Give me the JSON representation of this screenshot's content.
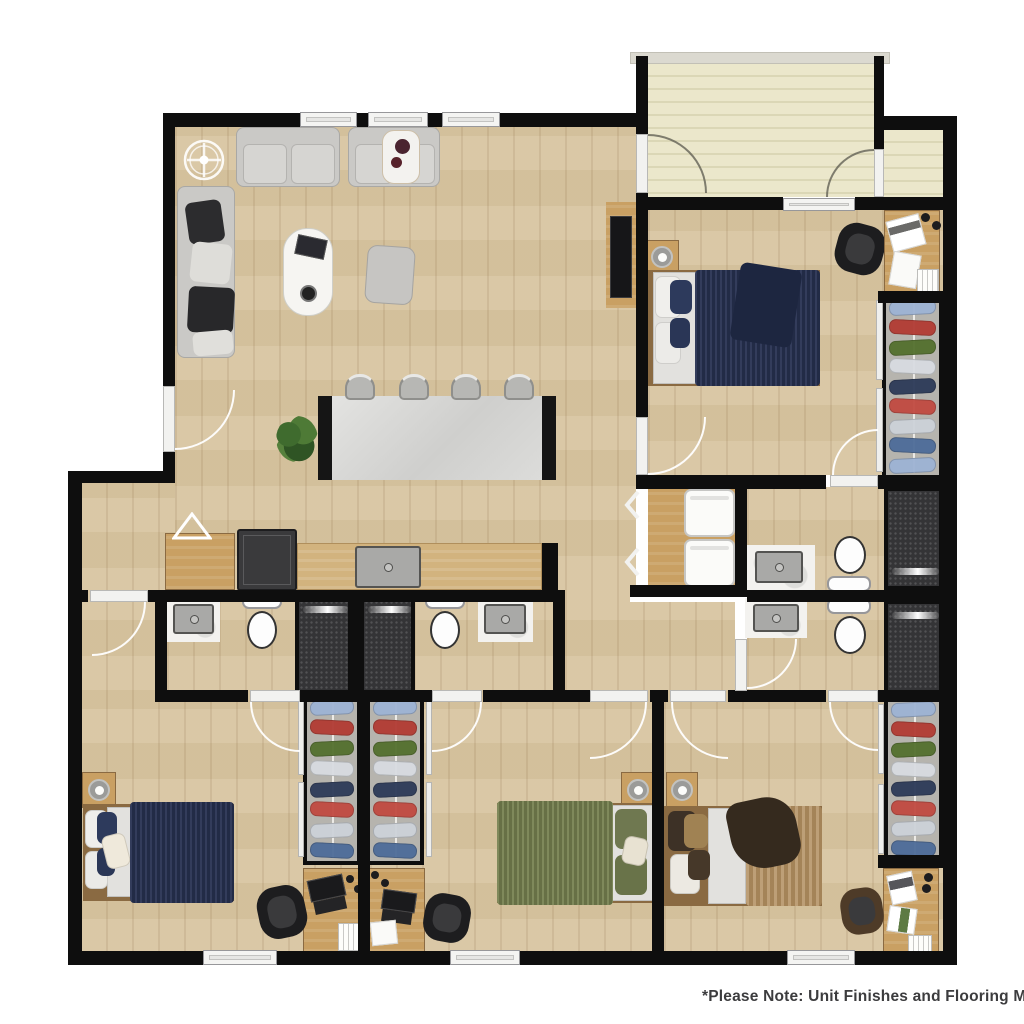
{
  "note": {
    "text": "*Please Note: Unit Finishes and Flooring May V"
  },
  "palette": {
    "wall": "#0e0e0e",
    "floor_wood": "#d8c5a1",
    "cabinet_wood": "#c9a063",
    "counter_wood": "#d2b37e",
    "patio_stripe_light": "#ebe7cb",
    "patio_stripe_dark": "#dbd7b6",
    "island_top": "#dbdbd8",
    "sofa_gray": "#cac9c6",
    "bed_navy": "#283252",
    "bed_green": "#75804f",
    "bed_tan": "#b49264",
    "shower_dark": "#343436",
    "closet_gray": "#b6b4ae",
    "fixture_white": "#fdfdfd"
  },
  "closets": {
    "garment_colors": [
      "#9db3d4",
      "#b23b33",
      "#54702e",
      "#d8dce1",
      "#2c3a58",
      "#c14a41",
      "#cdd2d9",
      "#4d6c99"
    ]
  },
  "floorplan": {
    "rooms": [
      "living-dining",
      "kitchen",
      "patio-balcony",
      "bedroom-1",
      "bedroom-2",
      "bedroom-3",
      "bedroom-4",
      "bathroom-1",
      "bathroom-2",
      "bathroom-3",
      "bathroom-4",
      "laundry-closet",
      "hallway"
    ],
    "bed_colors": {
      "bedroom_1": "navy",
      "bedroom_2": "navy",
      "bedroom_3": "green",
      "bedroom_4": "tan"
    },
    "fixtures": {
      "toilets": 4,
      "showers": 4,
      "bathroom_sinks": 4,
      "kitchen_sink": 1,
      "stacked_washer_dryer": 1,
      "closets_with_clothes": 4,
      "desks": 4,
      "ceiling_fan_symbol": 1
    }
  }
}
